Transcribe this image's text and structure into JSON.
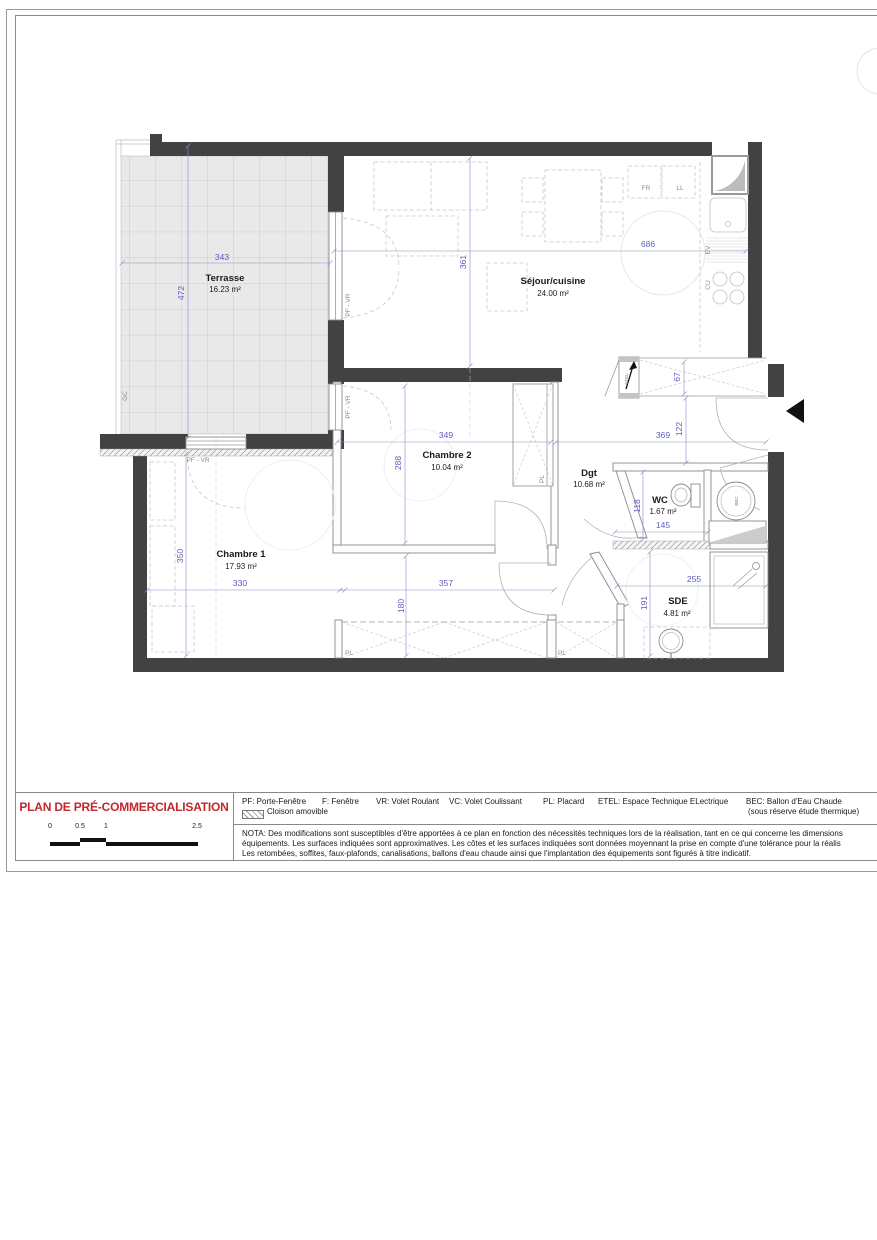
{
  "sheet": {
    "title": "PLAN DE PRÉ-COMMERCIALISATION",
    "scale_ticks": [
      "0",
      "0.5",
      "1",
      "2.5"
    ],
    "legend_abbr": [
      "PF: Porte-Fenêtre",
      "F: Fenêtre",
      "VR: Volet Roulant",
      "VC: Volet Coulissant",
      "PL: Placard",
      "ETEL: Espace Technique ELectrique",
      "BEC: Ballon d'Eau Chaude"
    ],
    "legend_bec_note": "(sous réserve étude thermique)",
    "legend_cloison": "Cloison amovible",
    "nota_lines": [
      "NOTA: Des modifications sont susceptibles d'être apportées à ce plan en fonction des nécessités techniques lors de la réalisation, tant en ce qui concerne les dimensions",
      "équipements. Les surfaces indiquées sont approximatives. Les côtes et les surfaces indiquées sont données moyennant la prise en compte d'une tolérance pour la réalis",
      "Les retombées, soffites, faux-plafonds, canalisations, ballons d'eau chaude ainsi que l'implantation des équipements sont figurés à titre indicatif."
    ]
  },
  "rooms": {
    "terrasse": {
      "name": "Terrasse",
      "area": "16.23 m²"
    },
    "sejour": {
      "name": "Séjour/cuisine",
      "area": "24.00 m²"
    },
    "chambre2": {
      "name": "Chambre 2",
      "area": "10.04 m²"
    },
    "chambre1": {
      "name": "Chambre 1",
      "area": "17.93 m²"
    },
    "dgt": {
      "name": "Dgt",
      "area": "10.68 m²"
    },
    "wc": {
      "name": "WC",
      "area": "1.67 m²"
    },
    "sde": {
      "name": "SDE",
      "area": "4.81 m²"
    }
  },
  "dims": {
    "terrasse_w": "343",
    "terrasse_h": "472",
    "sejour_w": "686",
    "sejour_h": "361",
    "chambre2_w": "349",
    "chambre2_h": "288",
    "entry_w": "369",
    "entry_h": "122",
    "etel_d": "67",
    "wc_h": "118",
    "wc_w": "145",
    "chambre1_w": "330",
    "chambre1_h": "350",
    "strip_w": "357",
    "pl_d": "180",
    "sde_h": "191",
    "sde_w": "255"
  },
  "tags": {
    "gc": "GC",
    "pf_vr": "PF - VR",
    "pl": "PL",
    "ev": "EV",
    "cu": "CU",
    "fr": "FR",
    "ll": "LL",
    "bec": "BEC",
    "etel": "ETEL"
  },
  "colors": {
    "dim_blue": "#5c5cc0",
    "wall_gray": "#424242",
    "title_red": "#c1272d"
  }
}
